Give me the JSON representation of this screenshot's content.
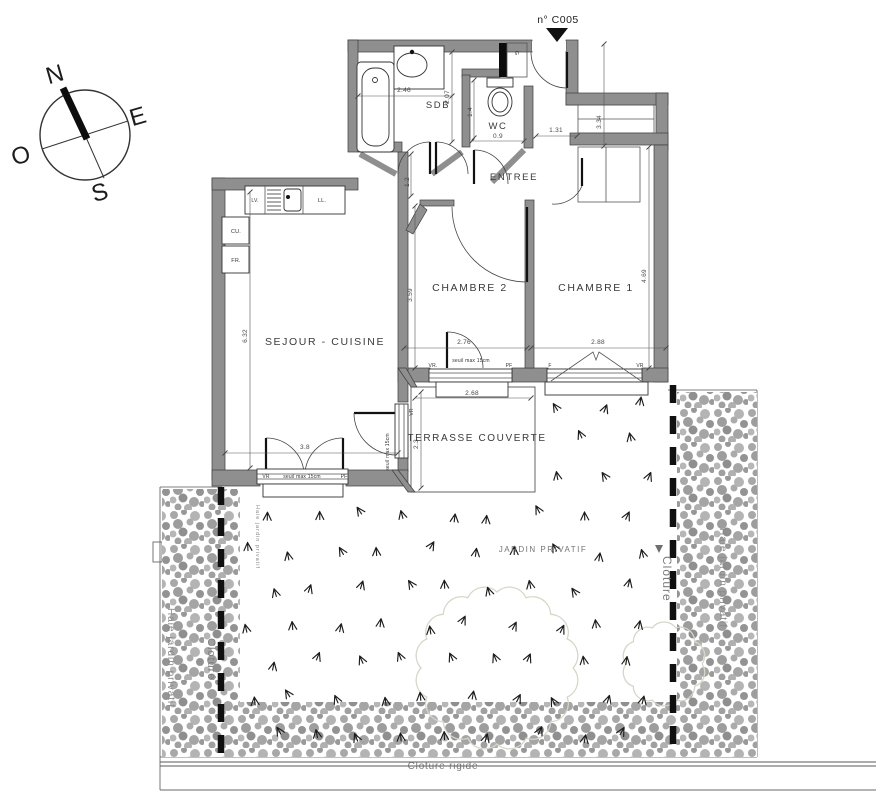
{
  "marker": {
    "label": "n° C005"
  },
  "compass": {
    "n": "N",
    "e": "E",
    "s": "S",
    "o": "O"
  },
  "rooms": {
    "sdb": "SDB",
    "wc": "WC",
    "entree": "ENTREE",
    "chambre1": "CHAMBRE 1",
    "chambre2": "CHAMBRE 2",
    "sejour": "SEJOUR - CUISINE",
    "terrasse": "TERRASSE COUVERTE"
  },
  "kitchen": {
    "lv": "LV.",
    "ll": "LL.",
    "cu": "CU.",
    "fr": "FR.",
    "gaine": "G"
  },
  "openings": {
    "seuil": "seuil max 15cm",
    "vr": "VR",
    "vr_dot": "VR.",
    "pf": "PF",
    "f": "F"
  },
  "dims": {
    "sdb_w": "2.46",
    "sdb_d": "2.07",
    "wc_w": "0.9",
    "wc_d": "1.4",
    "entree_w": "1.31",
    "entree_d": "3.34",
    "hall_w": "1.2",
    "sejour_d": "6.32",
    "sejour_door_w": "3.8",
    "ch2_d": "3.59",
    "ch2_w": "2.76",
    "ch1_d": "4.69",
    "ch1_w": "2.88",
    "terrasse_w": "2.68",
    "terrasse_d": "2.3"
  },
  "garden": {
    "jardin": "JARDIN PRIVATIF",
    "haie_left": "Haie jardin privatif",
    "haie_right": "Haie jardin privatif",
    "haie_small": "Haie jardin privatif",
    "cloture_left": "Cloturé",
    "cloture_right": "Cloture",
    "cloture_rigide": "Cloture rigide"
  },
  "colors": {
    "wall": "#8f8f8f",
    "hedge": "#a3a3a3",
    "dim": "#555555",
    "tree": "#d6d6c8"
  }
}
